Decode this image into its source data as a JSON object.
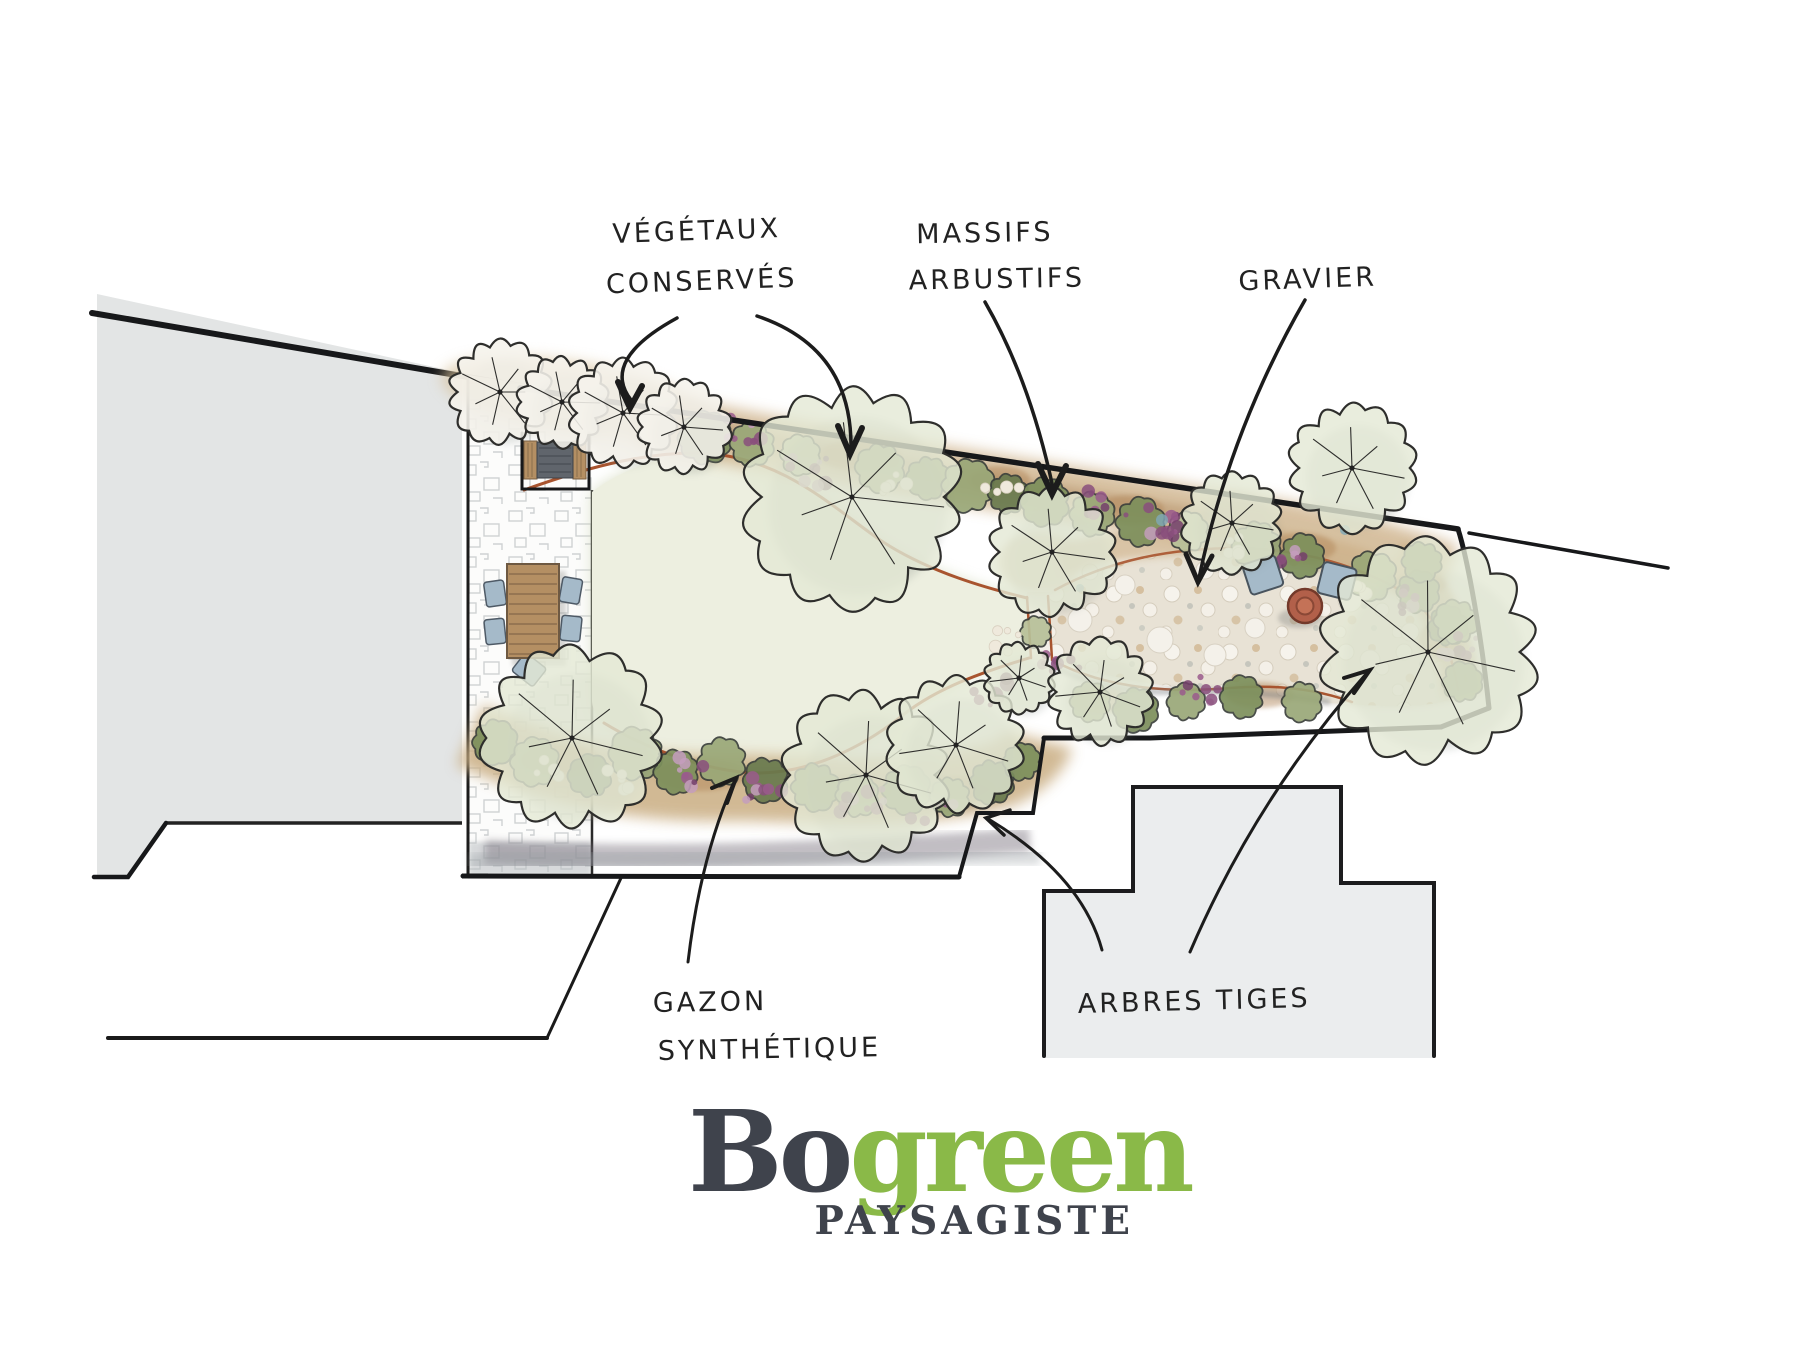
{
  "plan": {
    "annotations": [
      {
        "id": "vegetaux",
        "line1": "VÉGÉTAUX",
        "line2": "CONSERVÉS"
      },
      {
        "id": "massifs",
        "line1": "MASSIFS",
        "line2": "ARBUSTIFS"
      },
      {
        "id": "gravier",
        "line1": "GRAVIER",
        "line2": ""
      },
      {
        "id": "gazon",
        "line1": "GAZON",
        "line2": "SYNTHÉTIQUE"
      },
      {
        "id": "arbres",
        "line1": "ARBRES TIGES",
        "line2": ""
      }
    ]
  },
  "logo": {
    "brand_dark": "Bo",
    "brand_green": "green",
    "tagline": "PAYSAGISTE"
  },
  "colors": {
    "ink": "#222222",
    "logo_dark": "#3f434c",
    "logo_green": "#8ab948",
    "edging": "#a8542f",
    "lawn": "#edefe0",
    "lawn_shade": "#ccd3b2",
    "gravel_base": "#e8e2d5",
    "building": "#e3e5e5",
    "building2": "#ebedee",
    "soil": "#c9ad82",
    "soil_dark": "#b08457",
    "bush_sage": "#9aa878",
    "bush_olive": "#7d905c",
    "bush_light": "#b7c098",
    "bush_dark": "#697a4e",
    "flower_purples": [
      "#9a5a8c",
      "#74406b",
      "#c49ebd",
      "#8a4f7d"
    ],
    "flower_cream": "#efe9dc",
    "accent_teal": "#7fa9b8",
    "wood": "#b48f63",
    "cushion": "#60656c",
    "chair_blue": "#a5bac9",
    "terracotta": "#b2604a"
  }
}
